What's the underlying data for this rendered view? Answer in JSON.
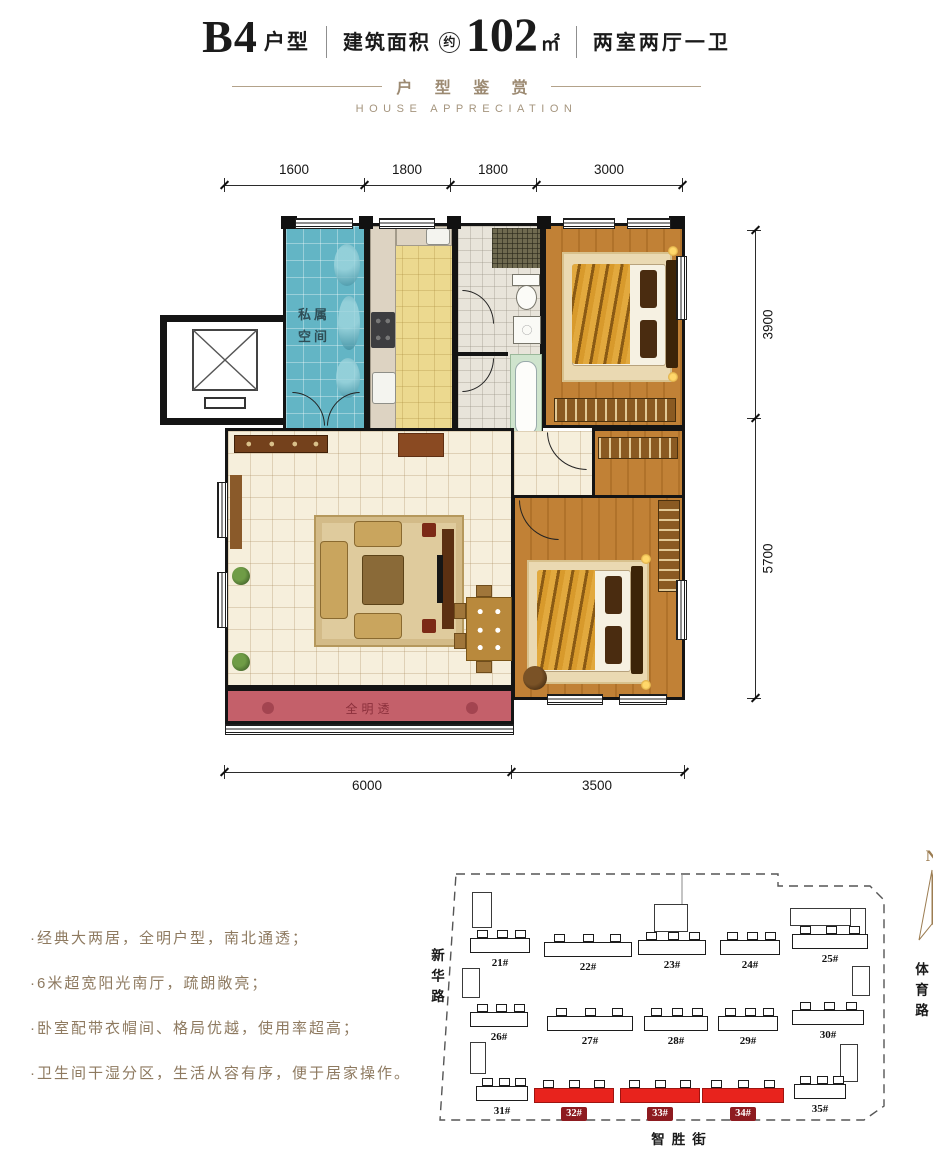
{
  "header": {
    "model": "B4",
    "model_suffix": "户型",
    "area_label": "建筑面积",
    "area_approx": "约",
    "area_value": "102",
    "area_unit": "㎡",
    "layout": "两室两厅一卫",
    "sub_cn": "户 型 鉴 赏",
    "sub_en": "HOUSE APPRECIATION"
  },
  "plan": {
    "dims_top": [
      "1600",
      "1800",
      "1800",
      "3000"
    ],
    "dims_right": [
      "3900",
      "5700"
    ],
    "dims_bottom": [
      "6000",
      "3500"
    ],
    "rooms": {
      "foyer_line1": "私属",
      "foyer_line2": "空间",
      "balcony": "全明透"
    },
    "compass": "N"
  },
  "features": {
    "items": [
      "·经典大两居，全明户型，南北通透；",
      "·6米超宽阳光南厅，疏朗敞亮；",
      "·卧室配带衣帽间、格局优越，使用率超高；",
      "·卫生间干湿分区，生活从容有序，便于居家操作。"
    ]
  },
  "site": {
    "roads": {
      "left": "新华路",
      "right": "体育路",
      "bottom": "智胜街"
    },
    "buildings": [
      {
        "label": "21#",
        "highlight": false
      },
      {
        "label": "22#",
        "highlight": false
      },
      {
        "label": "23#",
        "highlight": false
      },
      {
        "label": "24#",
        "highlight": false
      },
      {
        "label": "25#",
        "highlight": false
      },
      {
        "label": "26#",
        "highlight": false
      },
      {
        "label": "27#",
        "highlight": false
      },
      {
        "label": "28#",
        "highlight": false
      },
      {
        "label": "29#",
        "highlight": false
      },
      {
        "label": "30#",
        "highlight": false
      },
      {
        "label": "31#",
        "highlight": false
      },
      {
        "label": "32#",
        "highlight": true
      },
      {
        "label": "33#",
        "highlight": true
      },
      {
        "label": "34#",
        "highlight": true
      },
      {
        "label": "35#",
        "highlight": false
      }
    ],
    "highlight_color": "#e8231d",
    "badge_color": "#8e1b20"
  },
  "colors": {
    "accent_gold": "#9c8a72",
    "balcony_red": "#c4606a",
    "foyer_blue": "#63b5c5",
    "kitchen_yellow": "#ecd98f",
    "wood": "#c18136"
  }
}
